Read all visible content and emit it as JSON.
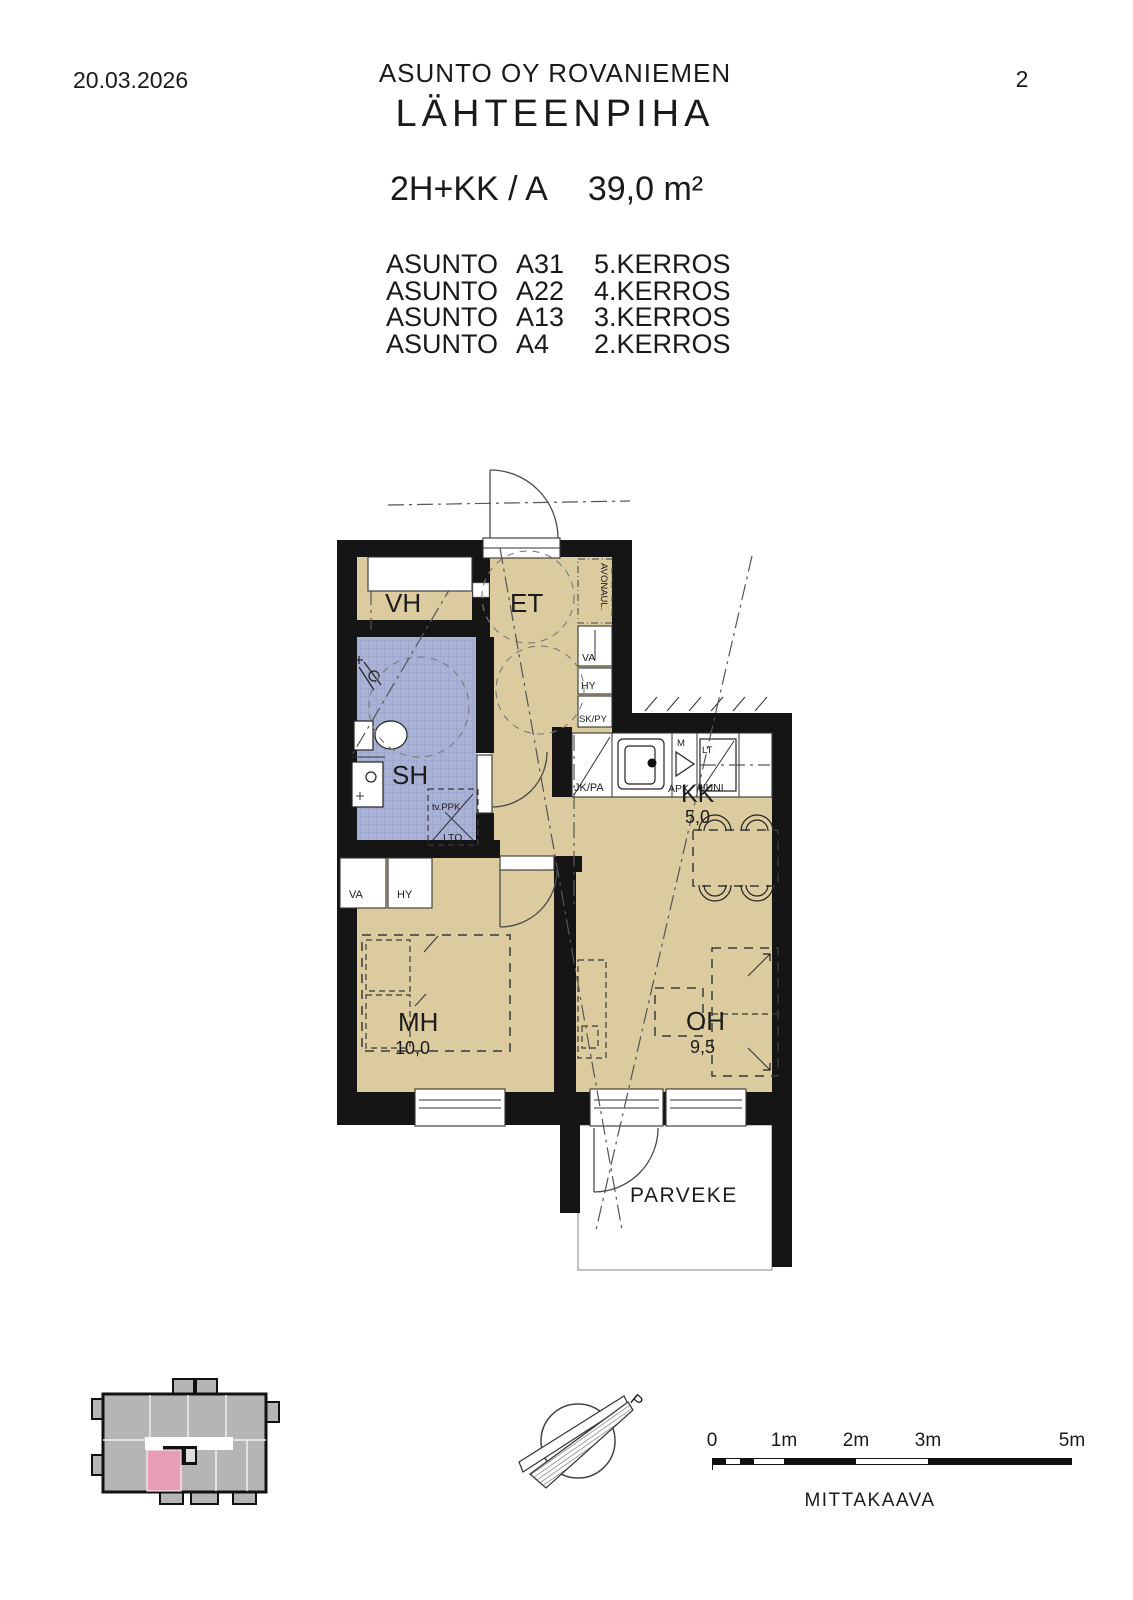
{
  "page": {
    "date": "20.03.2026",
    "company": "ASUNTO OY ROVANIEMEN",
    "project": "LÄHTEENPIHA",
    "page_number": "2"
  },
  "apartment": {
    "type": "2H+KK / A",
    "area": "39,0 m²"
  },
  "units": [
    {
      "label": "ASUNTO",
      "code": "A31",
      "floor": "5.KERROS"
    },
    {
      "label": "ASUNTO",
      "code": "A22",
      "floor": "4.KERROS"
    },
    {
      "label": "ASUNTO",
      "code": "A13",
      "floor": "3.KERROS"
    },
    {
      "label": "ASUNTO",
      "code": "A4",
      "floor": "2.KERROS"
    }
  ],
  "rooms": {
    "vh": "VH",
    "et": "ET",
    "sh": "SH",
    "kk": "KK",
    "kk_area": "5,0",
    "mh": "MH",
    "mh_area": "10,0",
    "oh": "OH",
    "oh_area": "9,5",
    "parveke": "PARVEKE"
  },
  "fixtures": {
    "avonaul": "AVONAUL.",
    "hall_va": "VA",
    "hall_hy": "HY",
    "hall_skpy": "SK/PY",
    "kitchen_jkpa": "JK/PA",
    "kitchen_m": "M",
    "kitchen_apk": "APK",
    "kitchen_lt": "LT",
    "kitchen_uuni": "UUNI",
    "bath_tvppk": "tv.PPK",
    "bath_lto": "LTO",
    "mh_va": "VA",
    "mh_hy": "HY"
  },
  "compass": {
    "north_letter": "P"
  },
  "scalebar": {
    "tick_labels": [
      "0",
      "1m",
      "2m",
      "3m",
      "5m"
    ],
    "caption": "MITTAKAAVA"
  },
  "colors": {
    "floor": "#dbcb9e",
    "wet_room": "#a9b2d5",
    "wet_room_grid": "#8f9ac4",
    "wall": "#151515",
    "unit_highlight": "#e79db5",
    "mini_building": "#b5b5b5"
  }
}
